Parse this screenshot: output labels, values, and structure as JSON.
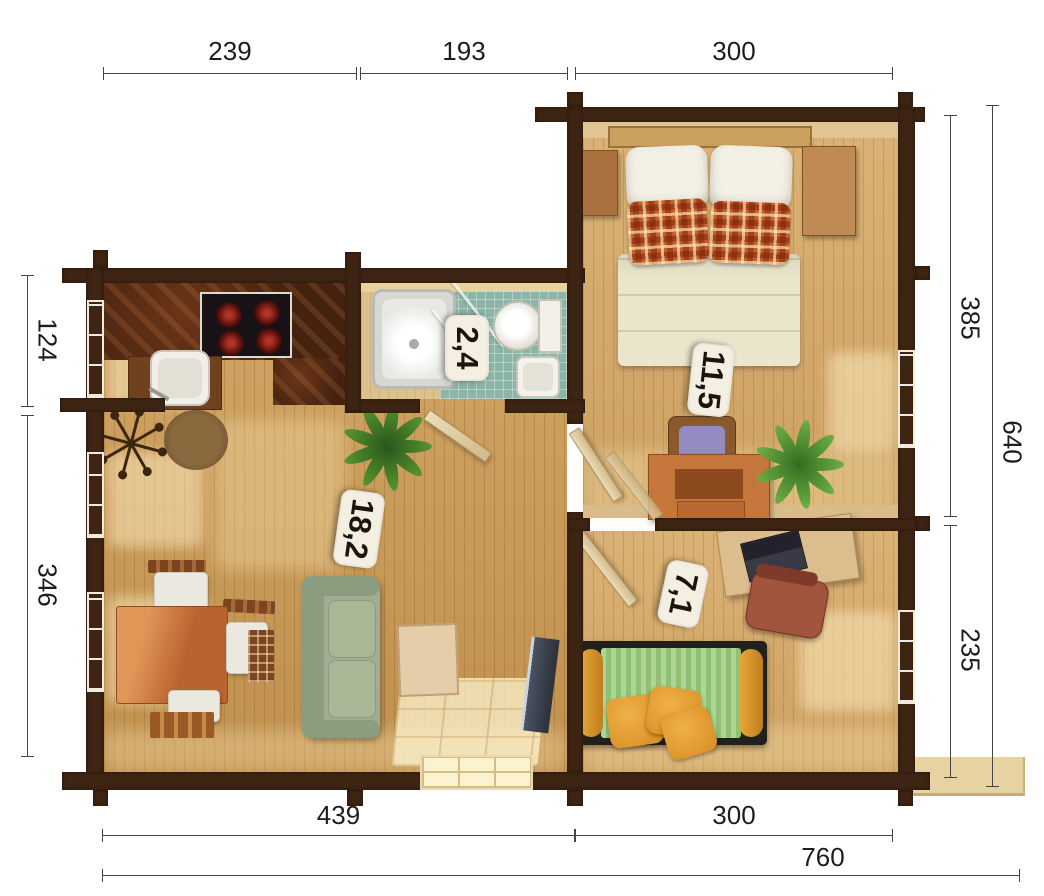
{
  "title": "log-cabin-floor-plan",
  "dimensions": {
    "top": [
      {
        "label": "239"
      },
      {
        "label": "193"
      },
      {
        "label": "300"
      }
    ],
    "bottom_inner": [
      {
        "label": "439"
      },
      {
        "label": "300"
      }
    ],
    "bottom_total": {
      "label": "760"
    },
    "left": [
      {
        "label": "124"
      },
      {
        "label": "346"
      }
    ],
    "right": [
      {
        "label": "385"
      },
      {
        "label": "235"
      }
    ],
    "right_total": {
      "label": "640"
    }
  },
  "rooms": {
    "bathroom": {
      "area": "2,4"
    },
    "bedroom": {
      "area": "11,5"
    },
    "living": {
      "area": "18,2"
    },
    "office": {
      "area": "7,1"
    }
  },
  "colors": {
    "wall": "#3e2413",
    "floor_living": "#cc9a52",
    "floor_bedroom": "#d7a966",
    "bathroom_tile": "#8cb4a7",
    "kitchen_counter": "#44220f",
    "daybed_green": "#9bcb81",
    "pillow_orange": "#e0992c",
    "sofa_green": "#9fae92",
    "label_bg": "#f4efe3"
  }
}
